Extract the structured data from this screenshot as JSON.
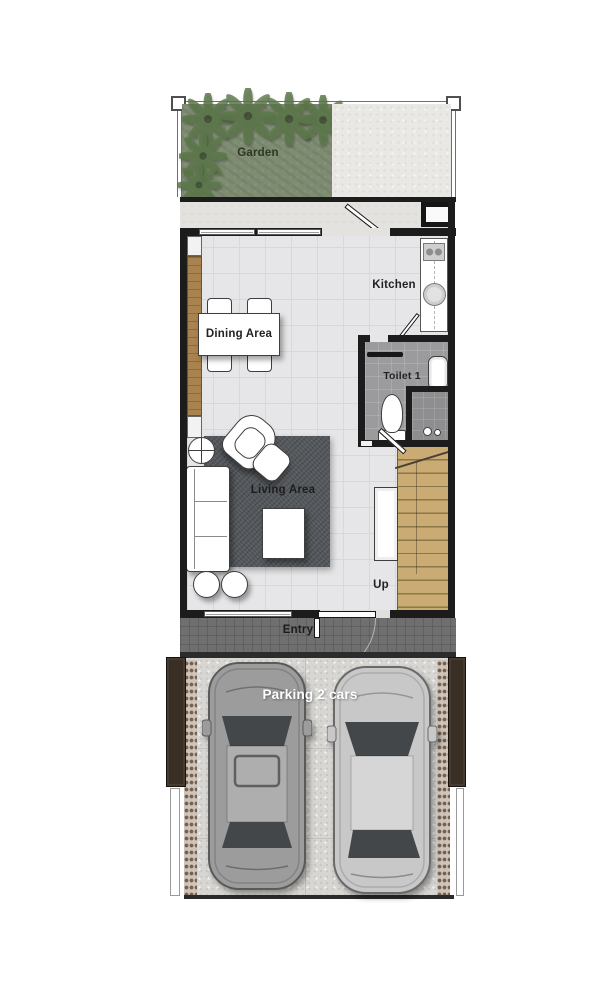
{
  "labels": {
    "garden": "Garden",
    "kitchen": "Kitchen",
    "dining": "Dining Area",
    "toilet": "Toilet 1",
    "living": "Living Area",
    "up": "Up",
    "entry": "Entry",
    "parking": "Parking 2 cars"
  },
  "icons": {
    "palm_tree": "radial-frond-cluster",
    "car_suv": "suv-top-view",
    "car_sedan": "sedan-top-view",
    "door": "quarter-arc-swing"
  },
  "colors": {
    "wall": "#1c1c1c",
    "floor": "#e6e6e8",
    "floor_line": "#d8d8db",
    "garden_green": "#7e8c72",
    "palm_green": "#5c784a",
    "concrete": "#e9e8e5",
    "terrace": "#e3e2df",
    "wood": "#a8834f",
    "stair_wood": "#c9ab73",
    "stair_line": "#8c7746",
    "toilet_floor": "#9b9b9d",
    "shower_floor": "#8e8e90",
    "rug": "#54585c",
    "entry_floor": "#6f6f6f",
    "slab": "#d7d6d2",
    "fence_brown": "#3a2f25",
    "gravel_bg": "#cdc5bb",
    "gravel_dot": "#77604c",
    "outline": "#3e3e3e",
    "car_suv_body": "#9c9c9c",
    "car_sedan_body": "#c8c8c8",
    "glass": "#43474a",
    "label_dark": "#222222",
    "label_light": "#ffffff"
  }
}
